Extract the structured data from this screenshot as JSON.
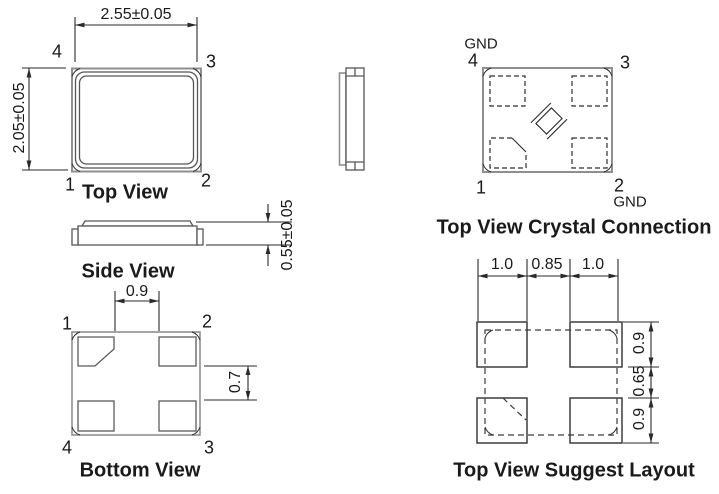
{
  "diagram": {
    "top_view": {
      "title": "Top View",
      "width_dim": "2.55±0.05",
      "height_dim": "2.05±0.05",
      "pin_tl": "4",
      "pin_tr": "3",
      "pin_bl": "1",
      "pin_br": "2"
    },
    "side_view": {
      "title": "Side View",
      "height_dim": "0.55±0.05"
    },
    "bottom_view": {
      "title": "Bottom View",
      "pad_gap_dim": "0.9",
      "pad_edge_dim": "0.7",
      "pin_tl": "1",
      "pin_tr": "2",
      "pin_bl": "4",
      "pin_br": "3"
    },
    "crystal_connection": {
      "title": "Top View Crystal Connection",
      "gnd_top": "GND",
      "gnd_bottom": "GND",
      "pin_tl": "4",
      "pin_tr": "3",
      "pin_bl": "1",
      "pin_br": "2"
    },
    "suggest_layout": {
      "title": "Top View Suggest Layout",
      "dim_left": "1.0",
      "dim_center": "0.85",
      "dim_right": "1.0",
      "dim_top_pad": "0.9",
      "dim_middle_gap": "0.65",
      "dim_bottom_pad": "0.9"
    }
  }
}
